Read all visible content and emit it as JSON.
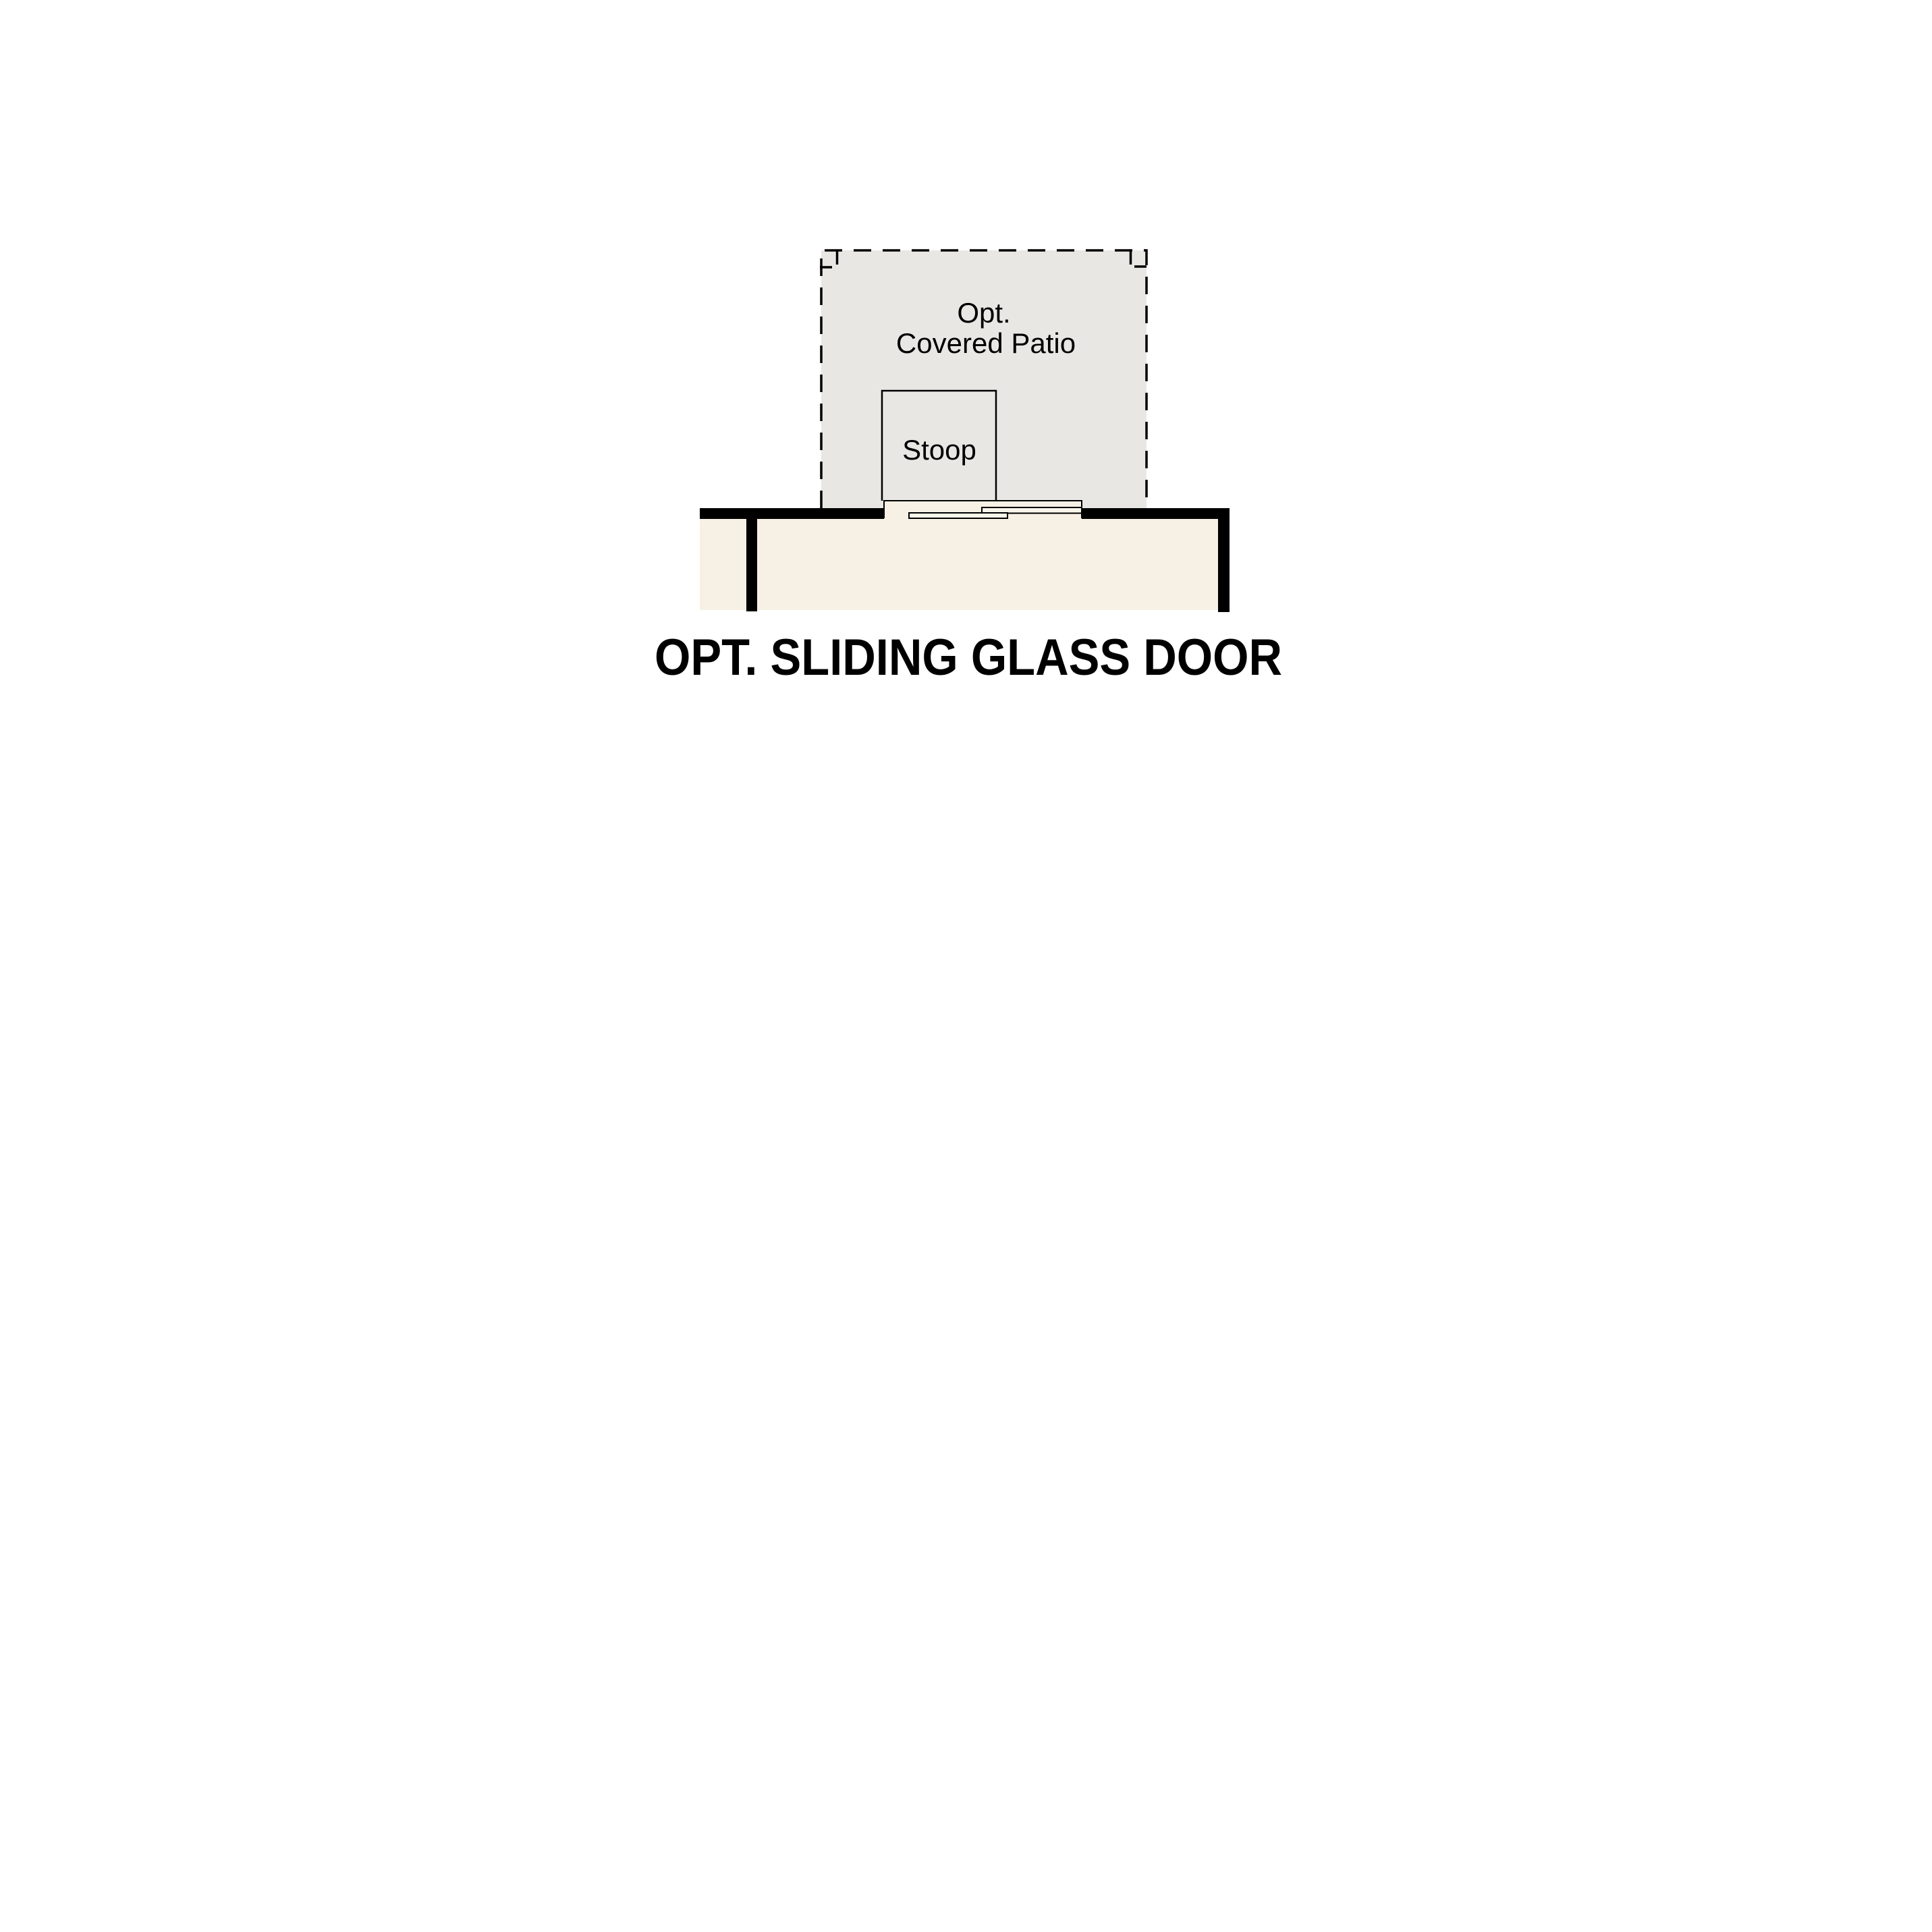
{
  "diagram": {
    "title": "OPT. SLIDING GLASS DOOR",
    "patio": {
      "label_line1": "Opt.",
      "label_line2": "Covered Patio"
    },
    "stoop": {
      "label": "Stoop"
    },
    "colors": {
      "background": "#ffffff",
      "patio_fill": "#e8e7e4",
      "floor_fill": "#f7f0e4",
      "sill_fill": "#f7f0e4",
      "panel_fill": "#faf5ea",
      "wall": "#000000",
      "line": "#000000",
      "text": "#000000"
    }
  }
}
